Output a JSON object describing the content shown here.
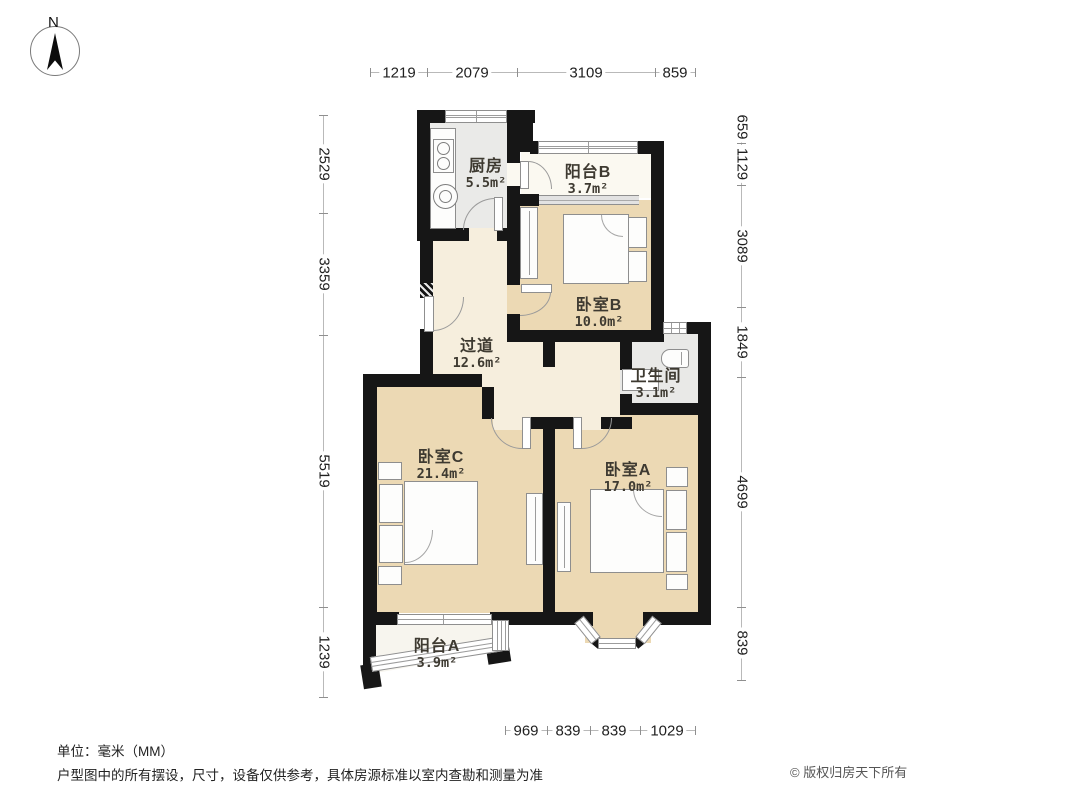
{
  "compass": {
    "label": "N"
  },
  "dims": {
    "top": [
      "1219",
      "2079",
      "3109",
      "859"
    ],
    "left": [
      "2529",
      "3359",
      "5519",
      "1239"
    ],
    "right": [
      "659",
      "1129",
      "3089",
      "1849",
      "4699",
      "839"
    ],
    "bottom": [
      "969",
      "839",
      "839",
      "1029"
    ]
  },
  "rooms": {
    "kitchen": {
      "name": "厨房",
      "area": "5.5m²"
    },
    "balcony_b": {
      "name": "阳台B",
      "area": "3.7m²"
    },
    "bedroom_b": {
      "name": "卧室B",
      "area": "10.0m²"
    },
    "hallway": {
      "name": "过道",
      "area": "12.6m²"
    },
    "bathroom": {
      "name": "卫生间",
      "area": "3.1m²"
    },
    "bedroom_c": {
      "name": "卧室C",
      "area": "21.4m²"
    },
    "bedroom_a": {
      "name": "卧室A",
      "area": "17.0m²"
    },
    "balcony_a": {
      "name": "阳台A",
      "area": "3.9m²"
    }
  },
  "footer": {
    "unit_note": "单位：毫米（MM）",
    "disclaimer": "户型图中的所有摆设，尺寸，设备仅供参考，具体房源标准以室内查勘和测量为准",
    "copyright": "© 版权归房天下所有"
  },
  "colors": {
    "wall": "#161616",
    "bedroom_floor": "#ecd9b4",
    "hallway_floor": "#f6eedd",
    "kitchen_floor": "#eaeae8",
    "accent_text": "#3e3a31"
  }
}
